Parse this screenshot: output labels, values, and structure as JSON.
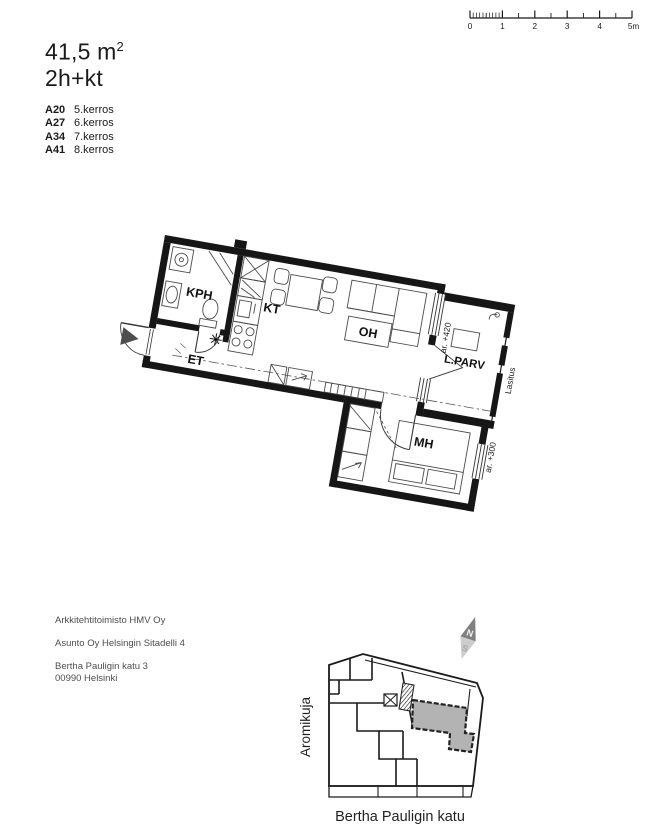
{
  "header": {
    "area_main": "41,5 m",
    "area_sup": "2",
    "type": "2h+kt"
  },
  "apartments": [
    {
      "code": "A20",
      "floor": "5.kerros"
    },
    {
      "code": "A27",
      "floor": "6.kerros"
    },
    {
      "code": "A34",
      "floor": "7.kerros"
    },
    {
      "code": "A41",
      "floor": "8.kerros"
    }
  ],
  "scalebar": {
    "labels": [
      "0",
      "1",
      "2",
      "3",
      "4",
      "5m"
    ]
  },
  "floorplan": {
    "rooms": {
      "kph": "KPH",
      "et": "ET",
      "kt": "KT",
      "oh": "OH",
      "lparv": "L.PARV",
      "mh": "MH"
    },
    "annotations": {
      "balcony_level": "ar. +420",
      "bedroom_level": "ar. +300",
      "glazing": "Lasitus"
    }
  },
  "footer": {
    "architect": "Arkkitehtitoimisto HMV Oy",
    "housing_company": "Asunto Oy Helsingin Sitadelli 4",
    "address_line1": "Bertha Pauligin katu 3",
    "address_line2": "00990 Helsinki"
  },
  "siteplan": {
    "street_left": "Aromikuja",
    "street_bottom": "Bertha Pauligin katu",
    "north_label": "N",
    "south_label": "S",
    "highlight_color": "#b3b3b3",
    "north_dark_color": "#808080",
    "north_light_color": "#cccccc"
  }
}
